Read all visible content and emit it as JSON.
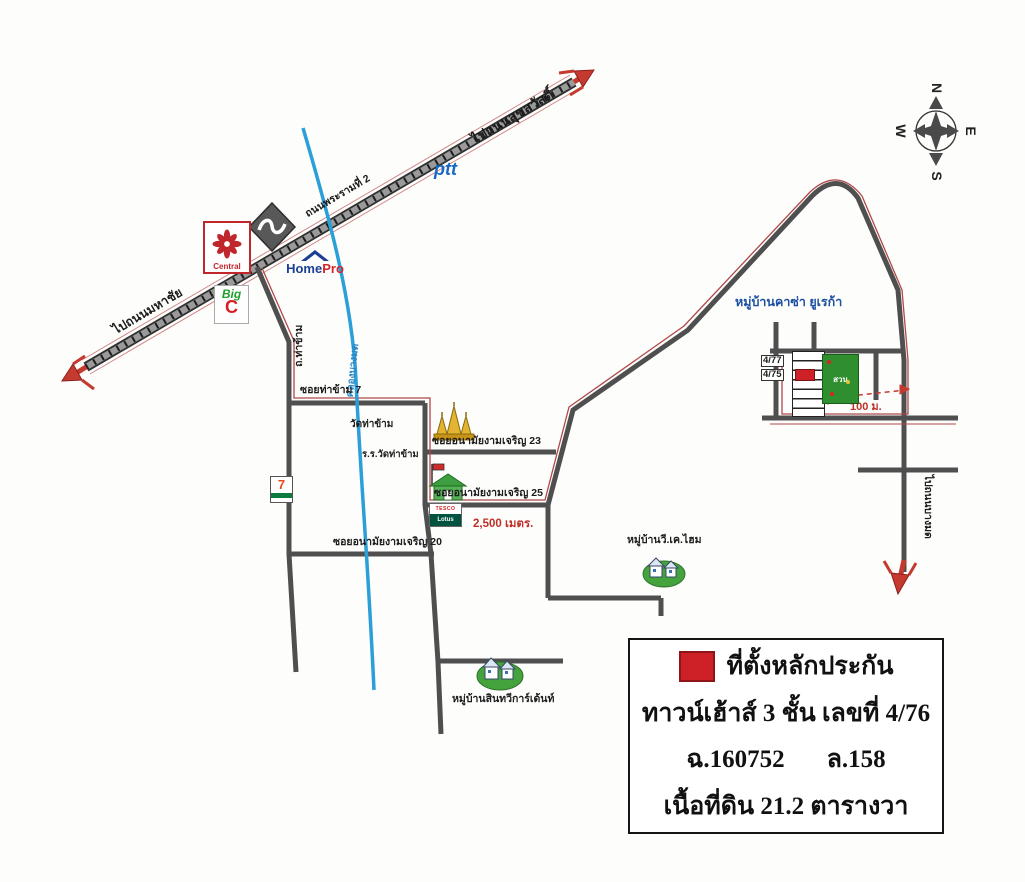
{
  "map": {
    "compass": {
      "n": "N",
      "e": "E",
      "s": "S",
      "w": "W"
    },
    "highway": {
      "name": "ถนนพระรามที่ 2",
      "to_northeast": "ไปถนนสุขสวัสดิ์",
      "to_southwest": "ไปถนนมหาชัย"
    },
    "roads": {
      "tha_kham": "ถ.ท่าข้าม",
      "canal": "คลองบางมด",
      "soi_tha_kham_7": "ซอยท่าข้าม 7",
      "soi_anamai_23": "ซอยอนามัยงามเจริญ 23",
      "soi_anamai_25": "ซอยอนามัยงามเจริญ 25",
      "soi_anamai_20": "ซอยอนามัยงามเจริญ 20",
      "to_bang_mot": "ไปถนนบางมด"
    },
    "distances": {
      "d2500": "2,500 เมตร.",
      "d100": "100 ม."
    },
    "places": {
      "temple": "วัดท่าข้าม",
      "school": "ร.ร.วัดท่าข้าม",
      "village_casa": "หมู่บ้านคาซ่า ยูเรก้า",
      "village_vk": "หมู่บ้านวี.เค.ไฮม",
      "village_sinthawee": "หมู่บ้านสินทวีการ์เด้นท์",
      "garden": "สวน",
      "house_4_77": "4/77",
      "house_4_75": "4/75"
    },
    "logos": {
      "ptt": "ptt",
      "central": "Central",
      "homepro_home": "Home",
      "homepro_pro": "Pro",
      "bigc_big": "Big",
      "bigc_c": "C",
      "seven": "7",
      "tesco": "TESCO",
      "lotus": "Lotus"
    },
    "legend": {
      "title": "ที่ตั้งหลักประกัน",
      "line2": "ทาวน์เฮ้าส์ 3 ชั้น เลขที่ 4/76",
      "line3a": "ฉ.160752",
      "line3b": "ล.158",
      "line4": "เนื้อที่ดิน 21.2 ตารางวา"
    },
    "colors": {
      "road_gray": "#4f4f4f",
      "arrow_red": "#c43a2e",
      "canal_blue": "#2b9fd8",
      "marker_red": "#ce2127",
      "village_blue": "#1c4fa0",
      "green": "#2f8f2f"
    }
  }
}
